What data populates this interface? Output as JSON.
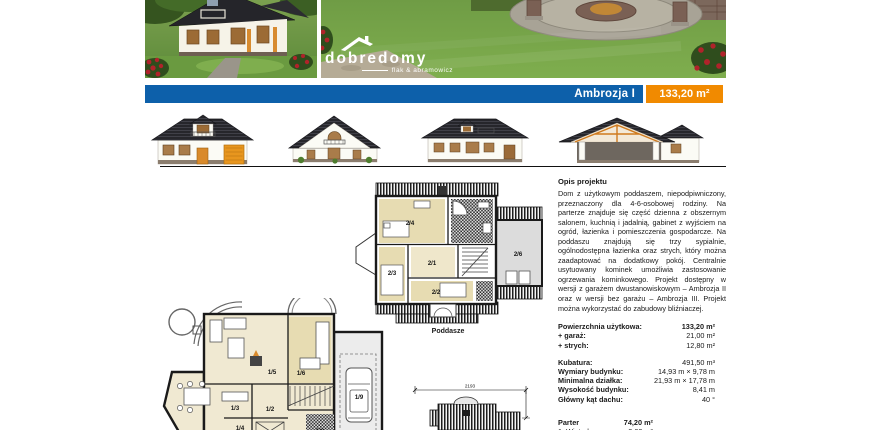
{
  "header": {
    "project_name": "Ambrozja I",
    "area": "133,20 m²"
  },
  "brand": {
    "name": "dobredomy",
    "tagline": "flak & abramowicz"
  },
  "colors": {
    "accent_blue": "#0d60aa",
    "accent_orange": "#f18a00",
    "plan_room_tan": "#e7dcb2",
    "plan_attic_gray": "#dcdcdc"
  },
  "description": {
    "heading": "Opis projektu",
    "body": "Dom z użytkowym poddaszem, niepodpiwniczony, przeznaczony dla 4-6-osobowej rodziny. Na parterze znajduje się część dzienna z obszernym salonem, kuchnią i jadalnią, gabinet z wyjściem na ogród, łazienka i pomieszczenia gospodarcze. Na poddaszu znajdują się trzy sypialnie, ogólnodostępna łazienka oraz strych, który można zaadaptować na dodatkowy pokój. Centralnie usytuowany kominek umożliwia zastosowanie ogrzewania kominkowego. Projekt dostępny w wersji z garażem dwustanowiskowym – Ambrozja II oraz w wersji bez garażu – Ambrozja III. Projekt można wykorzystać do zabudowy bliźniaczej."
  },
  "specs": [
    {
      "label": "Powierzchnia użytkowa:",
      "value": "133,20 m²"
    },
    {
      "label": "+ garaż:",
      "value": "21,00 m²"
    },
    {
      "label": "+ strych:",
      "value": "12,80 m²"
    },
    {
      "label": "Kubatura:",
      "value": "491,50 m³"
    },
    {
      "label": "Wymiary budynku:",
      "value": "14,93 m × 9,78 m"
    },
    {
      "label": "Minimalna działka:",
      "value": "21,93 m × 17,78 m"
    },
    {
      "label": "Wysokość budynku:",
      "value": "8,41 m"
    },
    {
      "label": "Główny kąt dachu:",
      "value": "40 °"
    }
  ],
  "rooms": {
    "floor_label": "Parter",
    "floor_area": "74,20 m²",
    "items": [
      {
        "label": "1. Wiatrołap",
        "value": "3,00 m²"
      }
    ]
  },
  "plans": {
    "attic_caption": "Poddasze",
    "attic_rooms": {
      "r1": "2/1",
      "r2": "2/2",
      "r3": "2/3",
      "r4": "2/4",
      "r6": "2/6"
    },
    "ground_rooms": {
      "r2": "1/2",
      "r3": "1/3",
      "r4": "1/4",
      "r5": "1/5",
      "r6": "1/6",
      "r8": "1/8",
      "r9": "1/9"
    },
    "site_dim_width": "2193"
  }
}
